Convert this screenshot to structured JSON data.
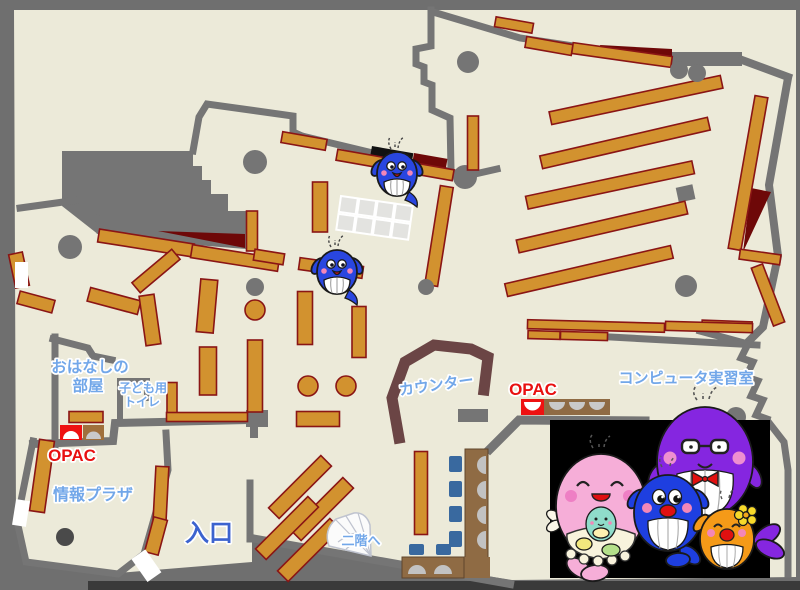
{
  "title": "図書館フロアマップ",
  "labels": {
    "ohanashi1": "おはなしの",
    "ohanashi2": "部屋",
    "kids1": "子ども用",
    "kids2": "トイレ",
    "opac_left": "OPAC",
    "opac_right": "OPAC",
    "info_plaza": "情報プラザ",
    "entrance": "入口",
    "stairs": "二階へ",
    "counter": "カウンター",
    "computer_room": "コンピュータ実習室"
  },
  "colors": {
    "floor": "#ecead9",
    "wall": "#757575",
    "frame": "#6f6f6f",
    "bookshelf": "#d2922f",
    "bookshelf_border": "#8a1515",
    "dark_red_area": "#6e0808",
    "counter_brown": "#6b4545",
    "desk_brown": "#8f6b44",
    "chair_blue": "#39699f",
    "label_blue": "#72a7e9",
    "entrance_blue": "#3c63cf",
    "opac_red": "#e81010",
    "mascot_panel": "#000000"
  },
  "mascots": {
    "map_whales": 2,
    "family": [
      "pink-mother-whale-with-baby",
      "purple-father-whale-glasses",
      "blue-child-whale",
      "orange-child-whale-flower"
    ]
  }
}
